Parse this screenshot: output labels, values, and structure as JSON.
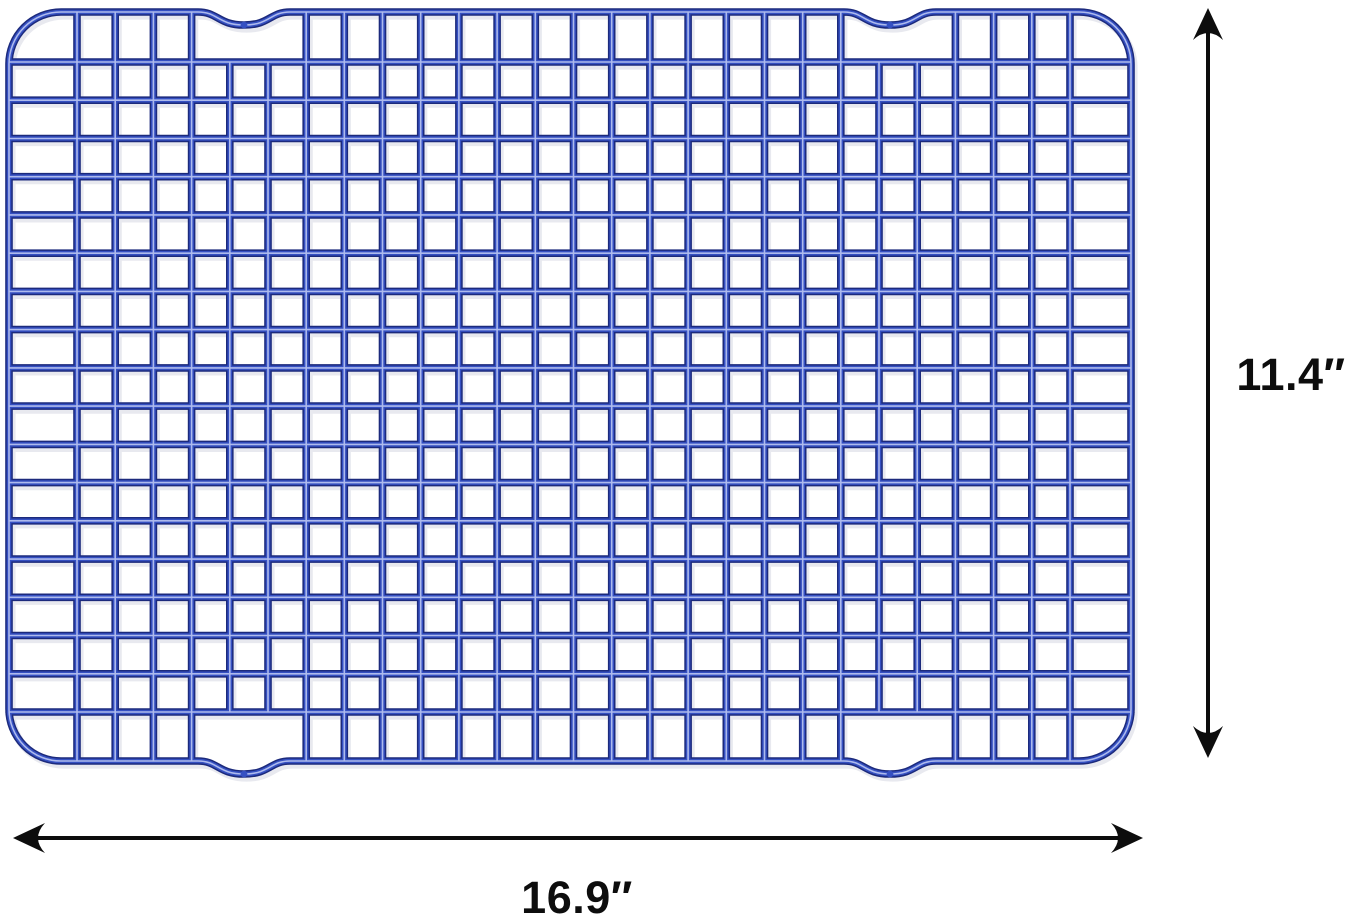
{
  "image_type": "product dimension diagram",
  "background_color": "#ffffff",
  "rack": {
    "name": "blue wire cooling rack",
    "colors": {
      "wire_dark": "#1c2a7c",
      "wire_mid": "#3550c2",
      "wire_highlight": "#bac5f2",
      "wire_shadow": "#e0e2ea"
    },
    "geometry": {
      "left": 9,
      "top": 12,
      "right": 1131,
      "bottom": 761,
      "corner_radius": 52,
      "wire_width_dark": 7.6,
      "wire_width_mid": 4.6,
      "wire_width_highlight": 1.6,
      "vertical_wires": {
        "first_x": 77,
        "last_x": 1070,
        "count": 27
      },
      "horizontal_wires": {
        "first_y": 62,
        "last_y": 712,
        "count": 18
      },
      "notches": {
        "centers_x": [
          244,
          890
        ],
        "half_width": 46,
        "depth": 13
      }
    }
  },
  "dimensions": {
    "height_label": "11.4″",
    "width_label": "16.9″",
    "arrow_color": "#0d0d0d",
    "arrow_line_width": 4,
    "height_arrow": {
      "x": 1208,
      "tip_top_y": 8,
      "tip_bottom_y": 758,
      "label_x": 1291,
      "label_y": 390,
      "font_size": 45
    },
    "width_arrow": {
      "y": 838,
      "tip_left_x": 13,
      "tip_right_x": 1143,
      "label_x": 577,
      "label_y": 913,
      "font_size": 45
    }
  }
}
